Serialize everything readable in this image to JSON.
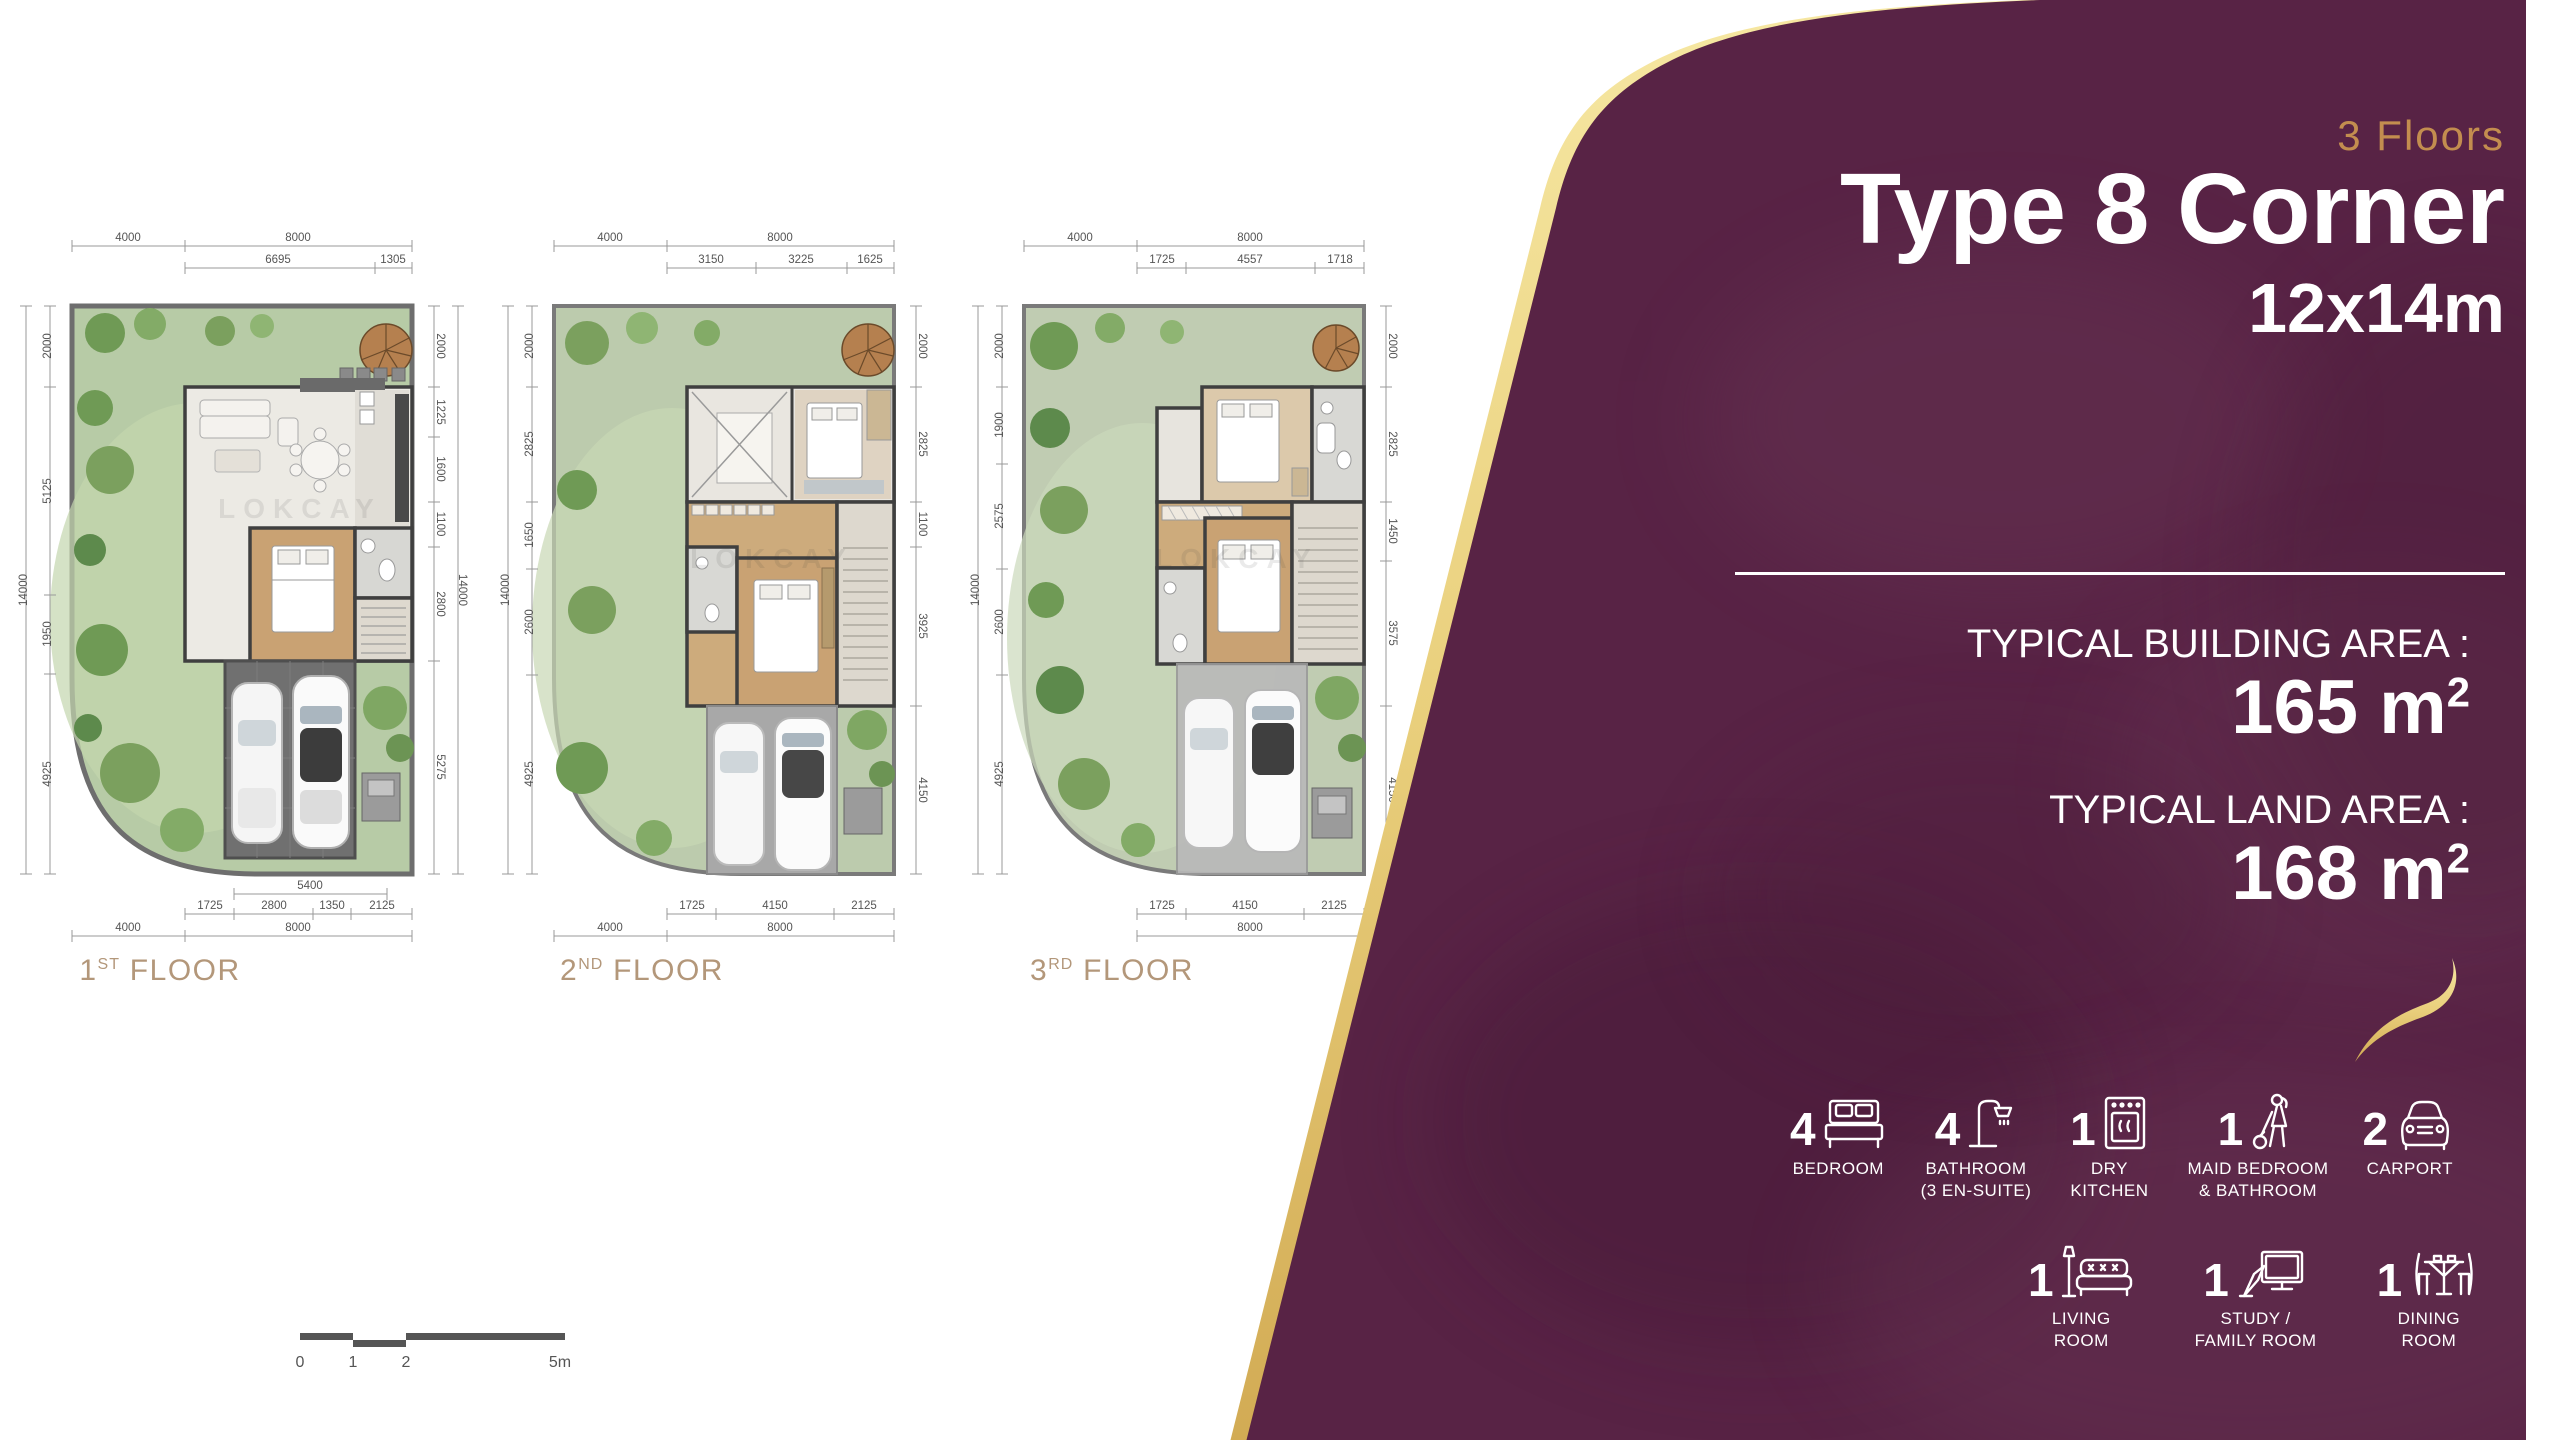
{
  "watermark": "LOKCAY",
  "colors": {
    "panel_maroon": "#582345",
    "gold_edge": "#f0d98c",
    "gold_text": "#c38d4f",
    "floor_label_tan": "#b3977a",
    "grass": "#b7cba6",
    "wood": "#c9a273"
  },
  "plans": [
    {
      "label": {
        "num": "1",
        "sup": "ST",
        "word": " FLOOR"
      },
      "dims": {
        "top": [
          "4000",
          "8000"
        ],
        "top_sub": [
          "6695",
          "1305"
        ],
        "left_total": "14000",
        "left": [
          "2000",
          "5125",
          "1950",
          "4925"
        ],
        "right": [
          "2000",
          "1225",
          "1600",
          "1100",
          "2800",
          "5275"
        ],
        "right_total": "14000",
        "bottom_span": "5400",
        "bottom_sub": [
          "1725",
          "2800",
          "1350",
          "2125"
        ],
        "bottom": [
          "4000",
          "8000"
        ]
      }
    },
    {
      "label": {
        "num": "2",
        "sup": "ND",
        "word": " FLOOR"
      },
      "dims": {
        "top": [
          "4000",
          "8000"
        ],
        "top_sub": [
          "3150",
          "3225",
          "1625"
        ],
        "left_total": "14000",
        "left": [
          "2000",
          "2825",
          "1650",
          "2600",
          "4925"
        ],
        "right": [
          "2000",
          "2825",
          "1100",
          "3925",
          "4150"
        ],
        "bottom_sub": [
          "1725",
          "4150",
          "2125"
        ],
        "bottom": [
          "4000",
          "8000"
        ]
      }
    },
    {
      "label": {
        "num": "3",
        "sup": "RD",
        "word": " FLOOR"
      },
      "dims": {
        "top": [
          "4000",
          "8000"
        ],
        "top_sub": [
          "1725",
          "4557",
          "1718"
        ],
        "left_total": "14000",
        "left": [
          "2000",
          "1900",
          "2575",
          "2600",
          "4925"
        ],
        "right": [
          "2000",
          "2825",
          "1450",
          "3575",
          "4150"
        ],
        "bottom_sub": [
          "1725",
          "4150",
          "2125"
        ],
        "bottom": [
          "8000"
        ]
      }
    }
  ],
  "scale_bar": {
    "labels": [
      "0",
      "1",
      "2",
      "5m"
    ]
  },
  "panel": {
    "floors_badge": "3 Floors",
    "title": "Type 8 Corner",
    "dimensions": "12x14m",
    "building_area_label": "TYPICAL BUILDING AREA :",
    "building_area_value": "165 m",
    "building_area_sup": "2",
    "land_area_label": "TYPICAL LAND AREA :",
    "land_area_value": "168 m",
    "land_area_sup": "2",
    "features_row1": [
      {
        "count": "4",
        "icon": "bed-icon",
        "line1": "BEDROOM",
        "line2": ""
      },
      {
        "count": "4",
        "icon": "shower-icon",
        "line1": "BATHROOM",
        "line2": "(3 EN-SUITE)"
      },
      {
        "count": "1",
        "icon": "oven-icon",
        "line1": "DRY",
        "line2": "KITCHEN"
      },
      {
        "count": "1",
        "icon": "maid-icon",
        "line1": "MAID BEDROOM",
        "line2": "& BATHROOM"
      },
      {
        "count": "2",
        "icon": "car-icon",
        "line1": "CARPORT",
        "line2": ""
      }
    ],
    "features_row2": [
      {
        "count": "1",
        "icon": "sofa-icon",
        "line1": "LIVING",
        "line2": "ROOM"
      },
      {
        "count": "1",
        "icon": "desk-icon",
        "line1": "STUDY /",
        "line2": "FAMILY ROOM"
      },
      {
        "count": "1",
        "icon": "dining-icon",
        "line1": "DINING",
        "line2": "ROOM"
      }
    ]
  }
}
